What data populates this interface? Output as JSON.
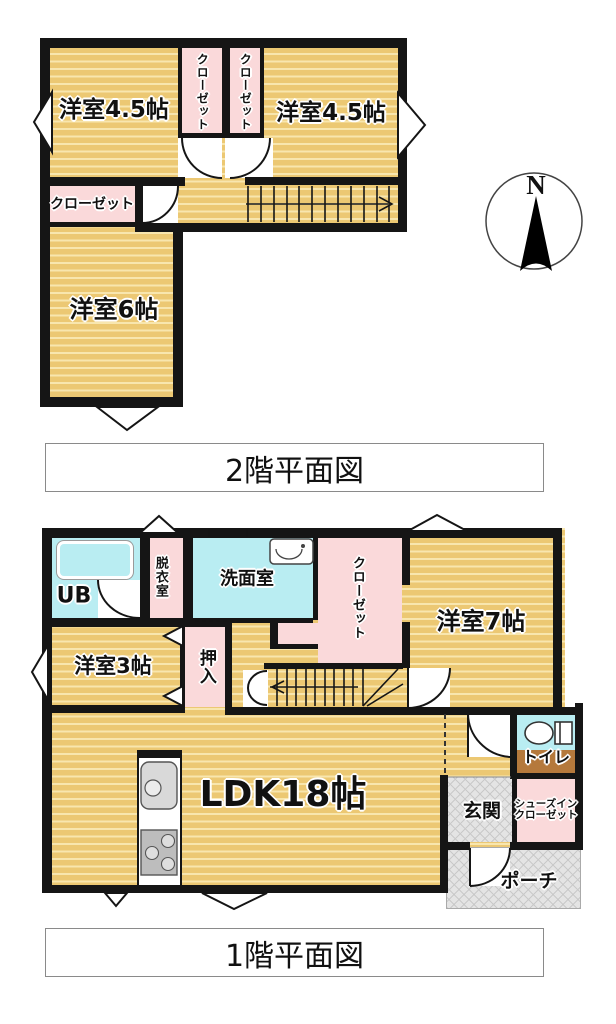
{
  "floor2": {
    "caption": "2階平面図",
    "rooms": {
      "bedroom_left": "洋室4.5帖",
      "bedroom_right": "洋室4.5帖",
      "closet_top_left": "クローゼット",
      "closet_top_right": "クローゼット",
      "closet_lower": "クローゼット",
      "bedroom_6": "洋室6帖"
    }
  },
  "floor1": {
    "caption": "1階平面図",
    "rooms": {
      "ub": "UB",
      "dressing_room": "脱衣室",
      "washroom": "洗面室",
      "closet": "クローゼット",
      "bedroom_7": "洋室7帖",
      "bedroom_3": "洋室3帖",
      "oshiire": "押入",
      "ldk": "LDK18帖",
      "toilet": "トイレ",
      "entrance": "玄関",
      "shoe_closet_line1": "シューズイン",
      "shoe_closet_line2": "クローゼット",
      "porch": "ポーチ"
    }
  },
  "compass": {
    "north_label": "N"
  },
  "colors": {
    "wall": "#151515",
    "room_floor": "#ecc873",
    "room_floor_stripe": "#f8e6ae",
    "closet_pink": "#fad9da",
    "wet_area_cyan": "#b9edf2",
    "toilet_floor_brown": "#b5793c",
    "tile_gray": "#e4e4e4"
  }
}
